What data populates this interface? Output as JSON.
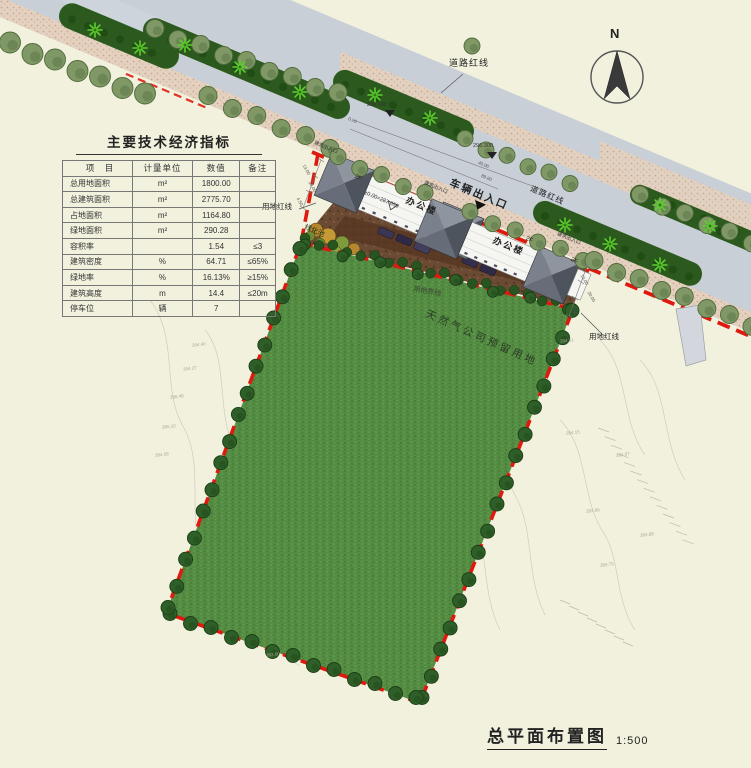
{
  "drawing": {
    "type": "site-plan",
    "accent_red": "#e0190f",
    "lawn_green": "#538c42",
    "road_gray": "#c9cfd7"
  },
  "indicators_table": {
    "title": "主要技术经济指标",
    "headers": [
      "项　目",
      "计量单位",
      "数值",
      "备注"
    ],
    "rows": [
      [
        "总用地面积",
        "m²",
        "1800.00",
        ""
      ],
      [
        "总建筑面积",
        "m²",
        "2775.70",
        ""
      ],
      [
        "占地面积",
        "m²",
        "1164.80",
        ""
      ],
      [
        "绿地面积",
        "m²",
        "290.28",
        ""
      ],
      [
        "容积率",
        "",
        "1.54",
        "≤3"
      ],
      [
        "建筑密度",
        "%",
        "64.71",
        "≤65%"
      ],
      [
        "绿地率",
        "%",
        "16.13%",
        "≥15%"
      ],
      [
        "建筑高度",
        "m",
        "14.4",
        "≤20m"
      ],
      [
        "停车位",
        "辆",
        "7",
        ""
      ]
    ]
  },
  "labels": {
    "north": "N",
    "road_redline": "道路红线",
    "site_redline": "用地红线",
    "site_boundary": "用地界线",
    "vehicle_entrance": "车辆出入口",
    "building_entrance": "建筑出入口",
    "office_building": "办公楼",
    "floors": "2F",
    "elevation_datum": "±0.00=287.650",
    "green_pool": "绿化池",
    "reserved_land": "天然气公司预留用地"
  },
  "dimensions": {
    "road_spot_elev_1": "288.000",
    "road_spot_elev_2": "296.300",
    "d020": "0.20",
    "d4000": "40.00",
    "d8960": "89.60",
    "d1300": "13.00",
    "d2000": "20.00",
    "d450": "4.50"
  },
  "survey_marks": [
    "294.40",
    "294.27",
    "286.48",
    "285.10",
    "284.58",
    "284.31",
    "284.15",
    "284.07",
    "283.96",
    "283.88",
    "283.75",
    "283.60"
  ],
  "title_block": {
    "title": "总平面布置图",
    "scale": "1:500"
  }
}
